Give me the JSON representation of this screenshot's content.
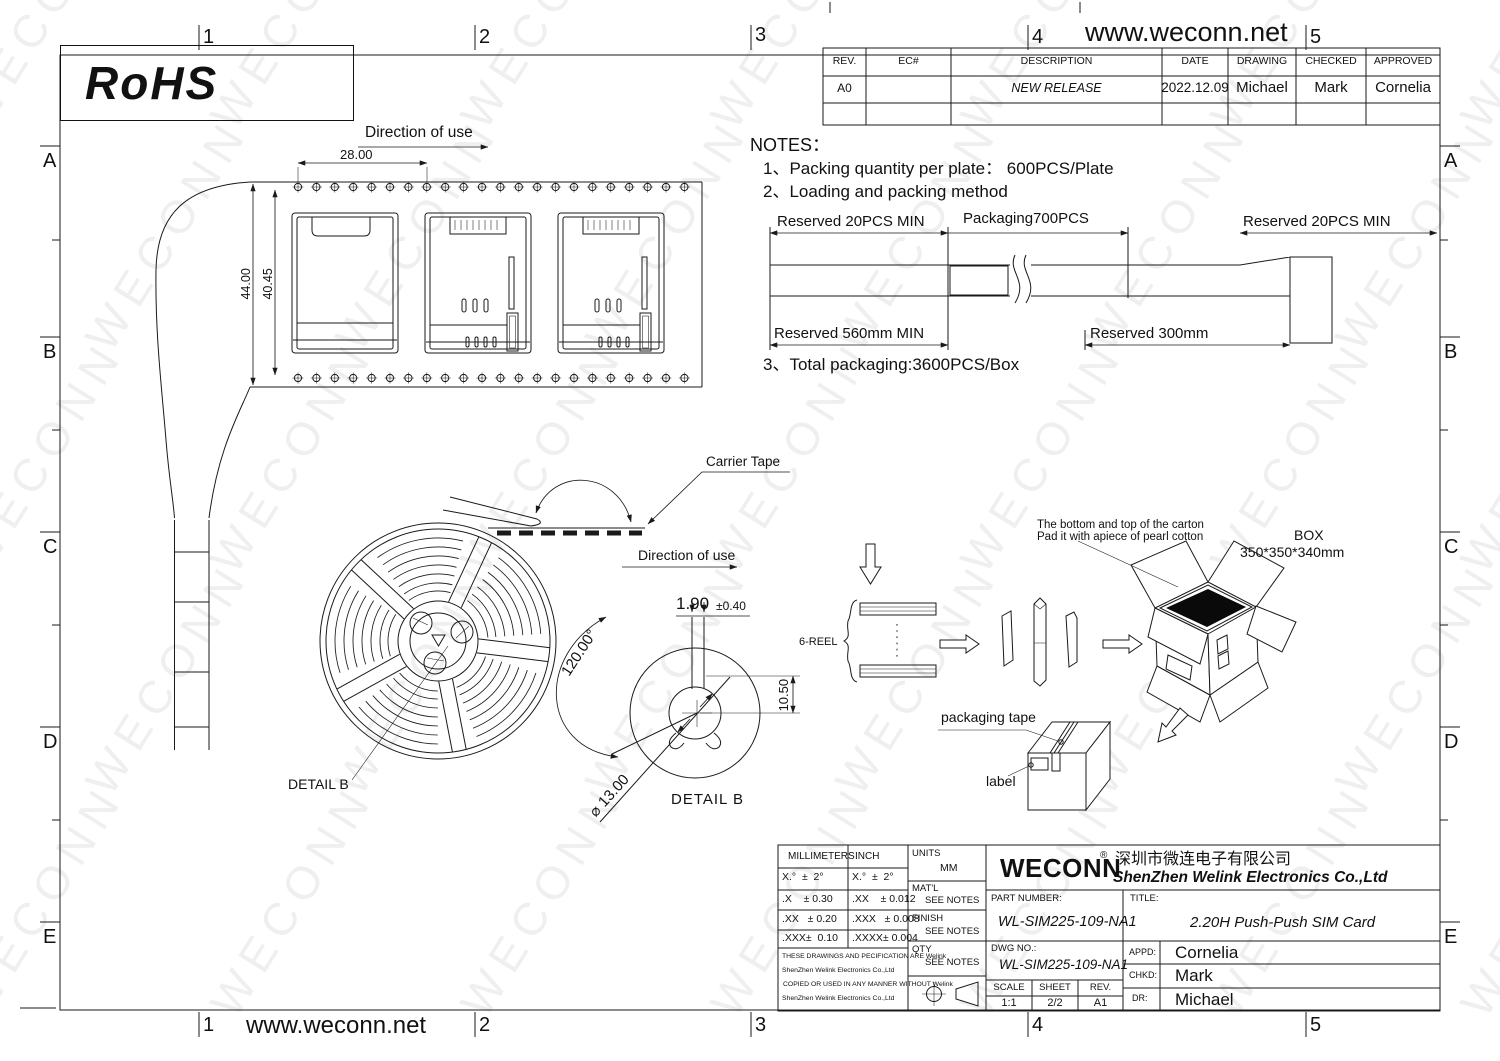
{
  "page": {
    "url_top": "www.weconn.net",
    "url_bottom": "www.weconn.net",
    "rohs": "RoHS"
  },
  "watermark": {
    "text": "WECONN"
  },
  "zones": {
    "cols": [
      "1",
      "2",
      "3",
      "4",
      "5"
    ],
    "rows": [
      "A",
      "B",
      "C",
      "D",
      "E"
    ]
  },
  "revision_table": {
    "headers": [
      "REV.",
      "EC#",
      "DESCRIPTION",
      "DATE",
      "DRAWING",
      "CHECKED",
      "APPROVED"
    ],
    "rows": [
      [
        "A0",
        "",
        "NEW RELEASE",
        "2022.12.09",
        "Michael",
        "Mark",
        "Cornelia"
      ],
      [
        "",
        "",
        "",
        "",
        "",
        "",
        ""
      ]
    ]
  },
  "notes": {
    "title": "NOTES：",
    "item1": "1、Packing quantity per plate：  600PCS/Plate",
    "item2": "2、Loading and packing method",
    "item3": "3、Total packaging:3600PCS/Box"
  },
  "packing": {
    "reserved_left": "Reserved 20PCS MIN",
    "packaging": "Packaging700PCS",
    "reserved_right": "Reserved 20PCS MIN",
    "reserved_560": "Reserved 560mm MIN",
    "reserved_300": "Reserved 300mm"
  },
  "tape": {
    "direction": "Direction of use",
    "dim_pitch": "28.00",
    "dim_width": "44.00",
    "dim_inner": "40.45"
  },
  "reel": {
    "detail_label": "DETAIL B",
    "carrier_tape": "Carrier Tape",
    "direction": "Direction of use"
  },
  "detail_b": {
    "label": "DETAIL  B",
    "dim_slot": "1.90",
    "tol": "±0.40",
    "angle": "120.00°",
    "height": "10.50",
    "diameter": "⌀ 13.00"
  },
  "flow": {
    "reel_stack": "6-REEL",
    "carton_note_1": "The bottom and top of the carton",
    "carton_note_2": "Pad it with apiece of pearl cotton",
    "box": "BOX",
    "box_size": "350*350*340mm",
    "tape": "packaging tape",
    "label": "label"
  },
  "title_block": {
    "tolerance": {
      "col_mm": "MILLIMETERS",
      "col_inch": "INCH",
      "mm_rows": [
        "X.°  ±  2°",
        ".X    ± 0.30",
        ".XX   ± 0.20",
        ".XXX±  0.10"
      ],
      "inch_rows": [
        "X.°  ±  2°",
        ".XX    ± 0.012",
        ".XXX   ± 0.008",
        ".XXXX± 0.004"
      ]
    },
    "legal": [
      "THESE DRAWINGS AND PECIFICATION ARE Welink",
      "ShenZhen Welink Electronics Co.,Ltd",
      "COPIED OR USED IN ANY MANNER WITHOUT Welink",
      "ShenZhen Welink Electronics Co.,Ltd"
    ],
    "units_label": "UNITS",
    "units_value": "MM",
    "matl_label": "MAT'L",
    "matl_value": "SEE NOTES",
    "finish_label": "FINISH",
    "finish_value": "SEE NOTES",
    "qty_label": "QTY",
    "qty_value": "SEE NOTES",
    "logo": "WECONN",
    "reg": "®",
    "company_cn": "深圳市微连电子有限公司",
    "company_en": "ShenZhen Welink Electronics Co.,Ltd",
    "part_number_label": "PART NUMBER:",
    "part_number": "WL-SIM225-109-NA1",
    "title_label": "TITLE:",
    "title": "2.20H Push-Push SIM Card",
    "dwg_no_label": "DWG NO.:",
    "dwg_no": "WL-SIM225-109-NA1",
    "scale_label": "SCALE",
    "scale": "1:1",
    "sheet_label": "SHEET",
    "sheet": "2/2",
    "rev_label": "REV.",
    "rev": "A1",
    "appd_label": "APPD:",
    "appd": "Cornelia",
    "chkd_label": "CHKD:",
    "chkd": "Mark",
    "dr_label": "DR:",
    "dr": "Michael"
  }
}
